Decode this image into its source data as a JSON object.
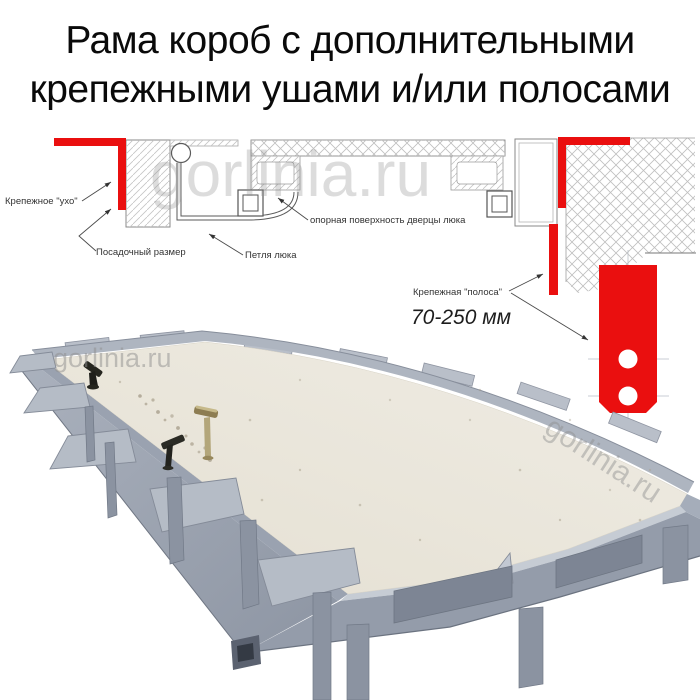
{
  "title": {
    "line1": "Рама короб с дополнительными",
    "line2": "крепежными ушами и/или полосами"
  },
  "watermark": {
    "text": "gorlinia.ru"
  },
  "diagram": {
    "labels": {
      "ear": "Крепежное \"ухо\"",
      "seat": "Посадочный размер",
      "hinge": "Петля люка",
      "support": "опорная поверхность дверцы люка",
      "strip": "Крепежная \"полоса\"",
      "range": "70-250 мм"
    },
    "colors": {
      "red": "#ea0f0f",
      "line": "#4a4a4a"
    }
  }
}
